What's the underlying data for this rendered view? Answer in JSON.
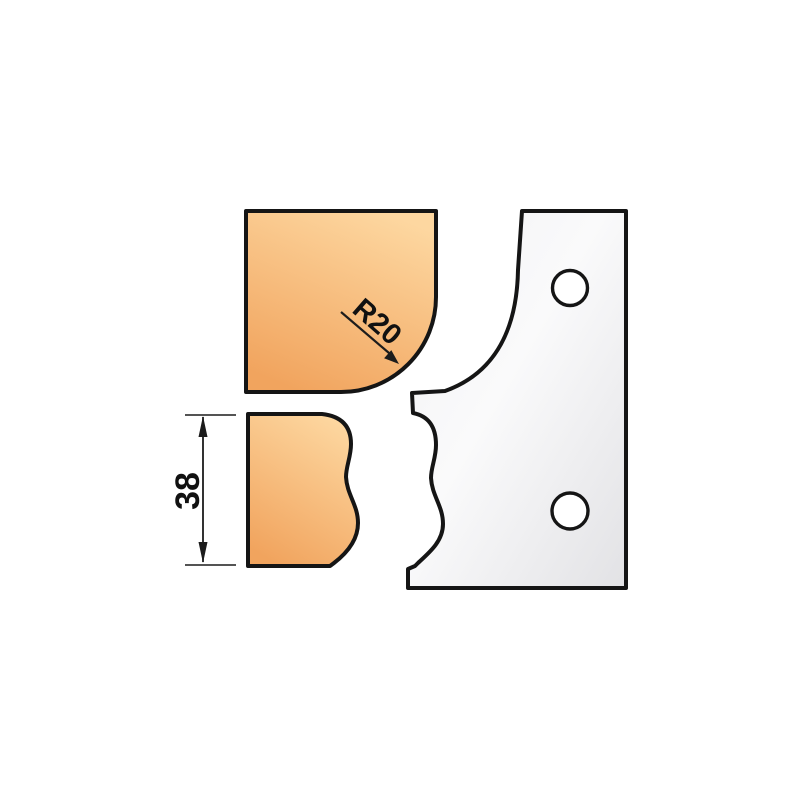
{
  "page": {
    "background": "#ffffff",
    "width": 800,
    "height": 800
  },
  "drawing": {
    "type": "technical-diagram",
    "subject": "moulding profile knife blank with matching wood profile cross-sections",
    "labels": {
      "radius_callout": "R20",
      "height_dimension": "38"
    },
    "colors": {
      "outline": "#151515",
      "wood_gradient_start": "#fdd7a0",
      "wood_gradient_end": "#f1a45e",
      "steel_gradient_start": "#f2f2f4",
      "steel_gradient_end": "#e2e2e5",
      "hole_fill": "#ffffff",
      "dimension_lines": "#1c1c1c"
    },
    "parts": [
      {
        "id": "wood-profile-top",
        "label": "wood cross-section with R20 round-over corner"
      },
      {
        "id": "wood-profile-bottom",
        "label": "wood cross-section with ogee edge"
      },
      {
        "id": "profile-knife-blank",
        "label": "steel profile knife with two mounting holes"
      }
    ],
    "hole_count": 2
  }
}
